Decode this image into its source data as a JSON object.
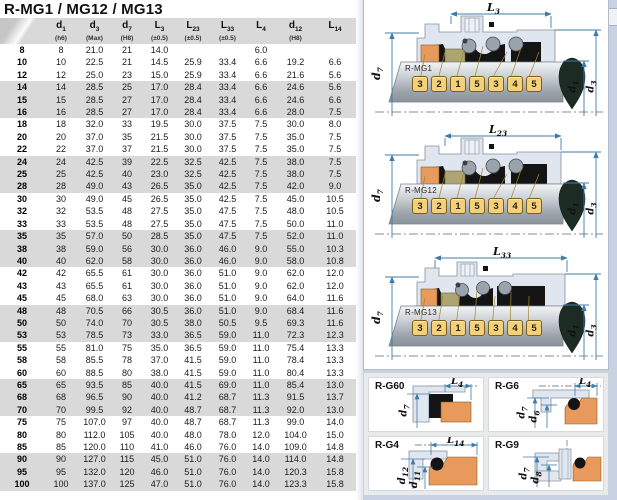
{
  "title": "R-MG1 / MG12 / MG13",
  "table": {
    "headers": [
      {
        "main": "",
        "sub": "",
        "note": ""
      },
      {
        "main": "d",
        "sub": "1",
        "note": "(h6)"
      },
      {
        "main": "d",
        "sub": "3",
        "note": "(Max)"
      },
      {
        "main": "d",
        "sub": "7",
        "note": "(H8)"
      },
      {
        "main": "L",
        "sub": "3",
        "note": "(±0.5)"
      },
      {
        "main": "L",
        "sub": "23",
        "note": "(±0.5)"
      },
      {
        "main": "L",
        "sub": "33",
        "note": "(±0.5)"
      },
      {
        "main": "L",
        "sub": "4",
        "note": ""
      },
      {
        "main": "d",
        "sub": "12",
        "note": "(H8)"
      },
      {
        "main": "L",
        "sub": "14",
        "note": ""
      }
    ],
    "rows": [
      [
        "8",
        "8",
        "21.0",
        "21",
        "14.0",
        "",
        "",
        "6.0",
        "",
        ""
      ],
      [
        "10",
        "10",
        "22.5",
        "21",
        "14.5",
        "25.9",
        "33.4",
        "6.6",
        "19.2",
        "6.6"
      ],
      [
        "12",
        "12",
        "25.0",
        "23",
        "15.0",
        "25.9",
        "33.4",
        "6.6",
        "21.6",
        "5.6"
      ],
      [
        "14",
        "14",
        "28.5",
        "25",
        "17.0",
        "28.4",
        "33.4",
        "6.6",
        "24.6",
        "5.6"
      ],
      [
        "15",
        "15",
        "28.5",
        "27",
        "17.0",
        "28.4",
        "33.4",
        "6.6",
        "24.6",
        "6.6"
      ],
      [
        "16",
        "16",
        "28.5",
        "27",
        "17.0",
        "28.4",
        "33.4",
        "6.6",
        "28.0",
        "7.5"
      ],
      [
        "18",
        "18",
        "32.0",
        "33",
        "19.5",
        "30.0",
        "37.5",
        "7.5",
        "30.0",
        "8.0"
      ],
      [
        "20",
        "20",
        "37.0",
        "35",
        "21.5",
        "30.0",
        "37.5",
        "7.5",
        "35.0",
        "7.5"
      ],
      [
        "22",
        "22",
        "37.0",
        "37",
        "21.5",
        "30.0",
        "37.5",
        "7.5",
        "35.0",
        "7.5"
      ],
      [
        "24",
        "24",
        "42.5",
        "39",
        "22.5",
        "32.5",
        "42.5",
        "7.5",
        "38.0",
        "7.5"
      ],
      [
        "25",
        "25",
        "42.5",
        "40",
        "23.0",
        "32.5",
        "42.5",
        "7.5",
        "38.0",
        "7.5"
      ],
      [
        "28",
        "28",
        "49.0",
        "43",
        "26.5",
        "35.0",
        "42.5",
        "7.5",
        "42.0",
        "9.0"
      ],
      [
        "30",
        "30",
        "49.0",
        "45",
        "26.5",
        "35.0",
        "42.5",
        "7.5",
        "45.0",
        "10.5"
      ],
      [
        "32",
        "32",
        "53.5",
        "48",
        "27.5",
        "35.0",
        "47.5",
        "7.5",
        "48.0",
        "10.5"
      ],
      [
        "33",
        "33",
        "53.5",
        "48",
        "27.5",
        "35.0",
        "47.5",
        "7.5",
        "50.0",
        "11.0"
      ],
      [
        "35",
        "35",
        "57.0",
        "50",
        "28.5",
        "35.0",
        "47.5",
        "7.5",
        "52.0",
        "11.0"
      ],
      [
        "38",
        "38",
        "59.0",
        "56",
        "30.0",
        "36.0",
        "46.0",
        "9.0",
        "55.0",
        "10.3"
      ],
      [
        "40",
        "40",
        "62.0",
        "58",
        "30.0",
        "36.0",
        "46.0",
        "9.0",
        "58.0",
        "10.8"
      ],
      [
        "42",
        "42",
        "65.5",
        "61",
        "30.0",
        "36.0",
        "51.0",
        "9.0",
        "62.0",
        "12.0"
      ],
      [
        "43",
        "43",
        "65.5",
        "61",
        "30.0",
        "36.0",
        "51.0",
        "9.0",
        "62.0",
        "12.0"
      ],
      [
        "45",
        "45",
        "68.0",
        "63",
        "30.0",
        "36.0",
        "51.0",
        "9.0",
        "64.0",
        "11.6"
      ],
      [
        "48",
        "48",
        "70.5",
        "66",
        "30.5",
        "36.0",
        "51.0",
        "9.0",
        "68.4",
        "11.6"
      ],
      [
        "50",
        "50",
        "74.0",
        "70",
        "30.5",
        "38.0",
        "50.5",
        "9.5",
        "69.3",
        "11.6"
      ],
      [
        "53",
        "53",
        "78.5",
        "73",
        "33.0",
        "36.5",
        "59.0",
        "11.0",
        "72.3",
        "12.3"
      ],
      [
        "55",
        "55",
        "81.0",
        "75",
        "35.0",
        "36.5",
        "59.0",
        "11.0",
        "75.4",
        "13.3"
      ],
      [
        "58",
        "58",
        "85.5",
        "78",
        "37.0",
        "41.5",
        "59.0",
        "11.0",
        "78.4",
        "13.3"
      ],
      [
        "60",
        "60",
        "88.5",
        "80",
        "38.0",
        "41.5",
        "59.0",
        "11.0",
        "80.4",
        "13.3"
      ],
      [
        "65",
        "65",
        "93.5",
        "85",
        "40.0",
        "41.5",
        "69.0",
        "11.0",
        "85.4",
        "13.0"
      ],
      [
        "68",
        "68",
        "96.5",
        "90",
        "40.0",
        "41.2",
        "68.7",
        "11.3",
        "91.5",
        "13.7"
      ],
      [
        "70",
        "70",
        "99.5",
        "92",
        "40.0",
        "48.7",
        "68.7",
        "11.3",
        "92.0",
        "13.0"
      ],
      [
        "75",
        "75",
        "107.0",
        "97",
        "40.0",
        "48.7",
        "68.7",
        "11.3",
        "99.0",
        "14.0"
      ],
      [
        "80",
        "80",
        "112.0",
        "105",
        "40.0",
        "48.0",
        "78.0",
        "12.0",
        "104.0",
        "15.0"
      ],
      [
        "85",
        "85",
        "120.0",
        "110",
        "41.0",
        "46.0",
        "76.0",
        "14.0",
        "109.0",
        "14.8"
      ],
      [
        "90",
        "90",
        "127.0",
        "115",
        "45.0",
        "51.0",
        "76.0",
        "14.0",
        "114.0",
        "14.8"
      ],
      [
        "95",
        "95",
        "132.0",
        "120",
        "46.0",
        "51.0",
        "76.0",
        "14.0",
        "120.3",
        "15.8"
      ],
      [
        "100",
        "100",
        "137.0",
        "125",
        "47.0",
        "51.0",
        "76.0",
        "14.0",
        "123.3",
        "15.8"
      ]
    ]
  },
  "diagrams": {
    "callout_numbers": [
      "3",
      "2",
      "1",
      "5",
      "3",
      "4",
      "5"
    ],
    "mg": [
      {
        "name": "R-MG1",
        "top": {
          "main": "L",
          "sub": "3"
        },
        "left": {
          "main": "d",
          "sub": "7"
        },
        "right1": {
          "main": "d",
          "sub": "1"
        },
        "right2": {
          "main": "d",
          "sub": "3"
        }
      },
      {
        "name": "R-MG12",
        "top": {
          "main": "L",
          "sub": "23"
        },
        "left": {
          "main": "d",
          "sub": "7"
        },
        "right1": {
          "main": "d",
          "sub": "1"
        },
        "right2": {
          "main": "d",
          "sub": "3"
        }
      },
      {
        "name": "R-MG13",
        "top": {
          "main": "L",
          "sub": "33"
        },
        "left": {
          "main": "d",
          "sub": "7"
        },
        "right1": {
          "main": "d",
          "sub": "1"
        },
        "right2": {
          "main": "d",
          "sub": "3"
        }
      }
    ]
  },
  "seats": [
    {
      "name": "R-G60",
      "top": {
        "main": "L",
        "sub": "4"
      },
      "left1": {
        "main": "d",
        "sub": "7"
      }
    },
    {
      "name": "R-G6",
      "top": {
        "main": "L",
        "sub": "4"
      },
      "left1": {
        "main": "d",
        "sub": "7"
      },
      "left2": {
        "main": "d",
        "sub": "6"
      }
    },
    {
      "name": "R-G4",
      "top": {
        "main": "L",
        "sub": "14"
      },
      "left1": {
        "main": "d",
        "sub": "12"
      },
      "left2": {
        "main": "d",
        "sub": "11"
      }
    },
    {
      "name": "R-G9",
      "left1": {
        "main": "d",
        "sub": "7"
      },
      "left2": {
        "main": "d",
        "sub": "8"
      }
    }
  ],
  "colors": {
    "accent": "#3f7ca8",
    "panel": "#c9d2e2",
    "diagram_fill": "#dfe6f0",
    "band": "#d9d9d9",
    "header": "#d9d9d9",
    "tag_fill": "#f3d07c",
    "tag_border": "#7c5f14",
    "orange": "#e79a5c",
    "olive": "#aca572",
    "dark_part": "#141414",
    "drop": "#1c2b24",
    "seat_area": "#e9eaec"
  }
}
